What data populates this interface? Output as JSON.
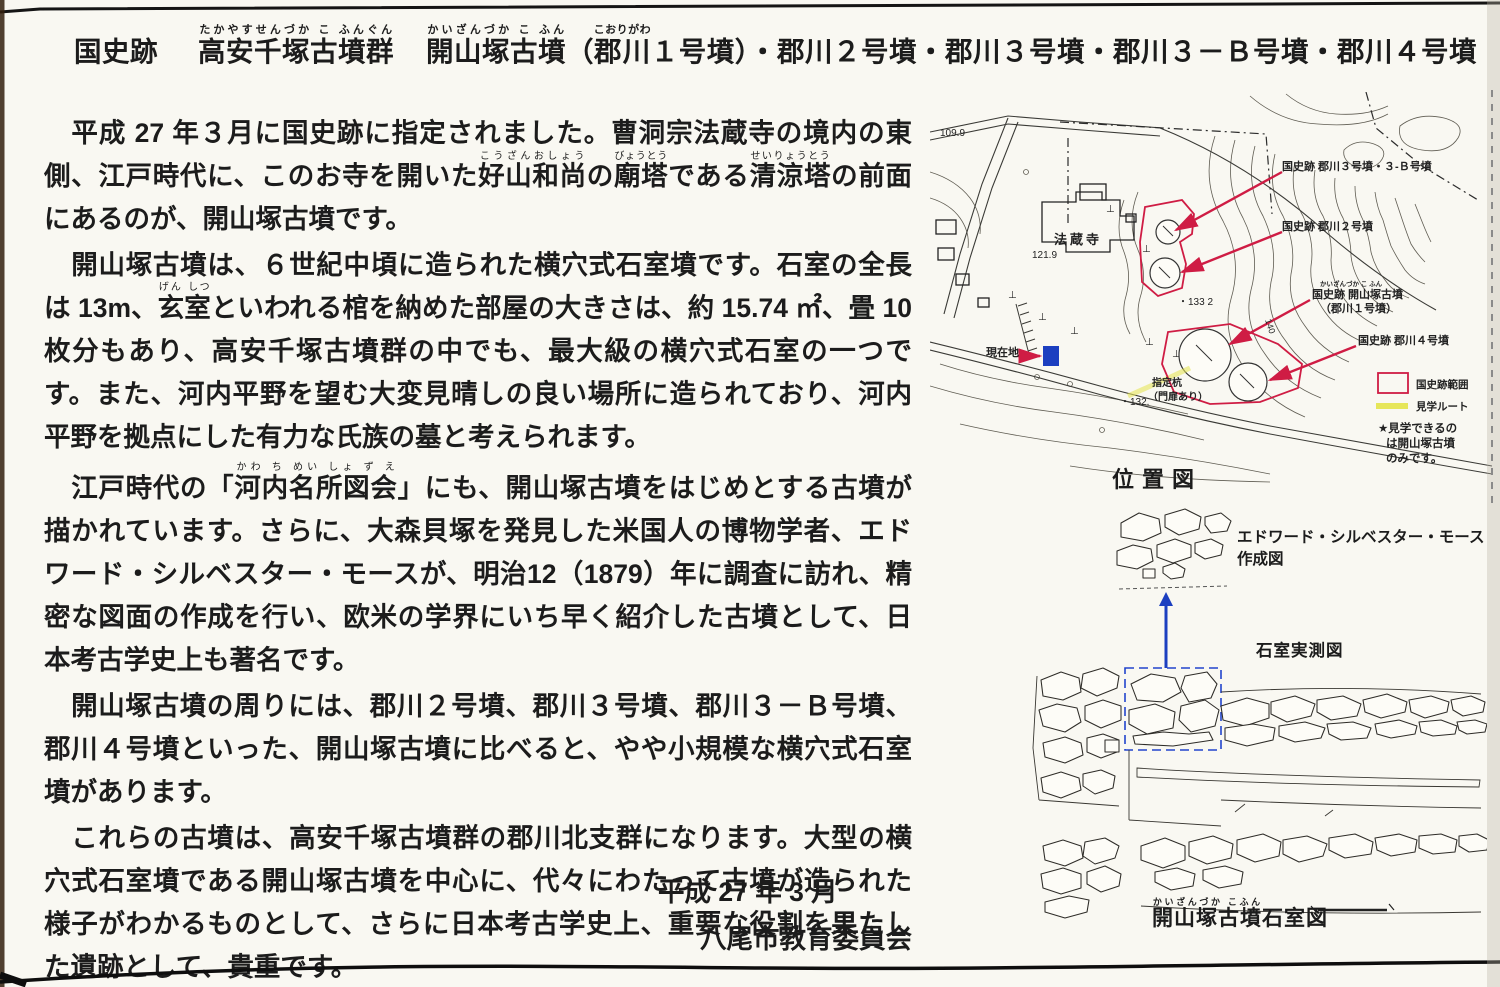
{
  "title": {
    "prefix": "国史跡",
    "name1": {
      "segments": [
        {
          "t": "高安千塚古墳群",
          "r": "たかやすせんづか こ ふんぐん"
        }
      ]
    },
    "name2": {
      "segments": [
        {
          "t": "開山塚古墳",
          "r": "かいざんづか こ ふん"
        },
        {
          "t": "（"
        },
        {
          "t": "郡川",
          "r": "こおりがわ"
        },
        {
          "t": "１号墳）・郡川２号墳・郡川３号墳・郡川３－Ｂ号墳・郡川４号墳"
        }
      ]
    }
  },
  "body": {
    "paragraphs": [
      {
        "segments": [
          {
            "t": "　平成 27 年３月に国史跡に指定されました。曹洞宗法蔵寺の境内の東側、江戸時代に、このお寺を開いた"
          },
          {
            "t": "好山和尚",
            "r": "こうざんおしょう"
          },
          {
            "t": "の"
          },
          {
            "t": "廟塔",
            "r": "びょうとう"
          },
          {
            "t": "である"
          },
          {
            "t": "清涼塔",
            "r": "せいりょうとう"
          },
          {
            "t": "の前面にあるのが、開山塚古墳です。"
          }
        ]
      },
      {
        "segments": [
          {
            "t": "　開山塚古墳は、６世紀中頃に造られた横穴式石室墳です。石室の全長は 13m、"
          },
          {
            "t": "玄室",
            "r": "げん しつ"
          },
          {
            "t": "といわれる棺を納めた部屋の大きさは、約 15.74 ㎡、畳 10 枚分もあり、高安千塚古墳群の中でも、最大級の横穴式石室の一つです。また、河内平野を望む大変見晴しの良い場所に造られており、河内平野を拠点にした有力な氏族の墓と考えられます。"
          }
        ]
      },
      {
        "segments": [
          {
            "t": "　江戸時代の「"
          },
          {
            "t": "河内名所図会",
            "r": "かわ ち めい しょ ず え"
          },
          {
            "t": "」にも、開山塚古墳をはじめとする古墳が描かれています。さらに、大森貝塚を発見した米国人の博物学者、エドワード・シルベスター・モースが、明治12（1879）年に調査に訪れ、精密な図面の作成を行い、欧米の学界にいち早く紹介した古墳として、日本考古学史上も著名です。"
          }
        ]
      },
      {
        "segments": [
          {
            "t": "　開山塚古墳の周りには、郡川２号墳、郡川３号墳、郡川３－Ｂ号墳、郡川４号墳といった、開山塚古墳に比べると、やや小規模な横穴式石室墳があります。"
          }
        ]
      },
      {
        "segments": [
          {
            "t": "　これらの古墳は、高安千塚古墳群の郡川北支群になります。大型の横穴式石室墳である開山塚古墳を中心に、代々にわたって古墳が造られた様子がわかるものとして、さらに日本考古学史上、重要な役割を果たした遺跡として、貴重です。"
          }
        ]
      }
    ],
    "signature": {
      "date": "平成 27 年 3 月",
      "org": "八尾市教育委員会"
    }
  },
  "map": {
    "caption": "位置図",
    "temple": "法蔵寺",
    "elevations": {
      "e1": "109.9",
      "e2": "121.9",
      "e3": "・133 2",
      "e4": "・132.",
      "contour": "140"
    },
    "site_labels": {
      "k3": "国史跡 郡川３号墳・３-Ｂ号墳",
      "k2": "国史跡 郡川２号墳",
      "k1_ruby": "かいざんづか こ ふん",
      "k1a": "国史跡 開山塚古墳",
      "k1b": "（郡川１号墳）",
      "k4": "国史跡 郡川４号墳"
    },
    "current_location": "現在地",
    "gate_note_line1": "指定杭",
    "gate_note_line2": "（門扉あり）",
    "legend": {
      "area": "国史跡範囲",
      "route": "見学ルート",
      "note_lines": [
        "★見学できるの",
        "は開山塚古墳",
        "のみです。"
      ]
    }
  },
  "figures": {
    "morse_label_line1": "エドワード・シルベスター・モース",
    "morse_label_line2": "作成図",
    "chamber_label": "石室実測図",
    "caption": {
      "segments": [
        {
          "t": "開山塚古墳",
          "r": "かいざんづか こふん"
        },
        {
          "t": "石室図"
        }
      ]
    }
  },
  "colors": {
    "accent_red": "#cf1c44",
    "accent_blue": "#1c3fc0",
    "route_yellow": "#e6e65a"
  }
}
